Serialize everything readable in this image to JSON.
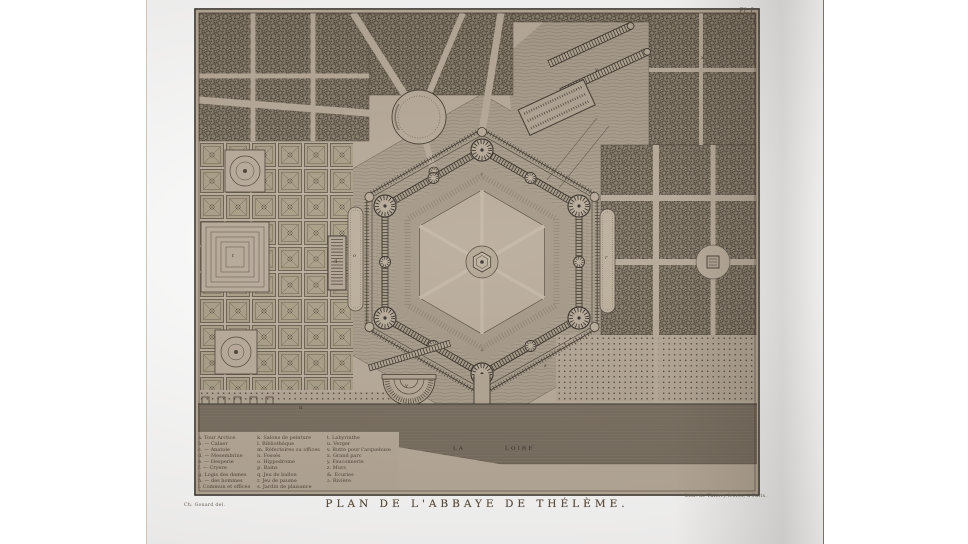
{
  "palette": {
    "paper": "#b4a796",
    "ink": "#3c342b",
    "woods": "#8a7f6f",
    "river": "#8f8374"
  },
  "plate": {
    "number": "Pl. I.",
    "title": "PLAN DE L'ABBAYE DE THÉLÈME.",
    "credit_left": "Ch. Gouard del.",
    "credit_right": "Lith. de Thierry frères, à Paris.",
    "river_label_1": "LA",
    "river_label_2": "LOIRE"
  },
  "legend": {
    "col1": [
      "a. Tour Arctice",
      "b. — Calaer",
      "c. — Anatole",
      "d. — Mesembrine",
      "e. — Hesperie",
      "f. — Cryere",
      "g. Logis des dames",
      "h. — des hommes",
      "i. Commun et offices"
    ],
    "col2": [
      "k. Salons de peinture",
      "l. Bibliothèque",
      "m. Réfectoires ou offices",
      "n. Fossés",
      "o. Hippodrome",
      "p. Bains",
      "q. Jeu de ballon",
      "r. Jeu de paume",
      "s. Jardin de plaisance"
    ],
    "col3": [
      "t. Labyrinthe",
      "u. Verger",
      "v. Butte pour l'arquebuse",
      "x. Grand parc",
      "y. Fauconnerie",
      "z. Murs",
      "&. Écuries",
      "ɔ. Rivière"
    ]
  },
  "plan_marks": [
    {
      "label": "t"
    },
    {
      "label": "q"
    },
    {
      "label": "o"
    },
    {
      "label": "r"
    },
    {
      "label": "v"
    },
    {
      "label": "s"
    },
    {
      "label": "x"
    },
    {
      "label": "u"
    },
    {
      "label": "y"
    }
  ]
}
